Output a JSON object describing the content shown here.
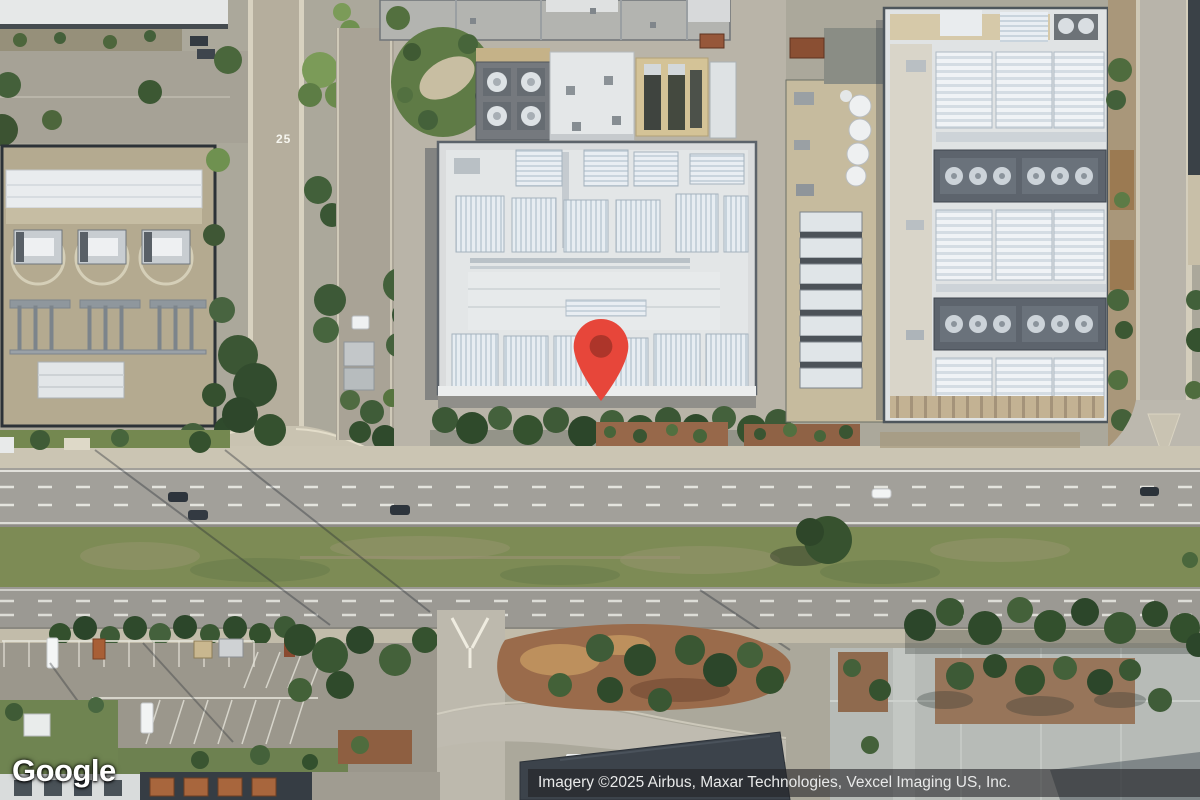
{
  "map": {
    "logo_text": "Google",
    "attribution": "Imagery ©2025 Airbus, Maxar Technologies, Vexcel Imaging US, Inc.",
    "road_marking": "25",
    "marker": {
      "icon": "red-map-pin",
      "color": "#e7463a",
      "inner_color": "#ad352a",
      "pixel_x": 601,
      "pixel_y": 401
    },
    "colors": {
      "road_asphalt": "#a2a09a",
      "median_grass": "#7d8b55",
      "white_roof": "#e3e6e7",
      "hvac_unit": "#dde5ec",
      "substation_ground": "#b4aa90",
      "tree_green": "#3a5733",
      "mulch_brown": "#97684a",
      "attribution_bg": "rgba(32,33,36,0.58)"
    }
  }
}
